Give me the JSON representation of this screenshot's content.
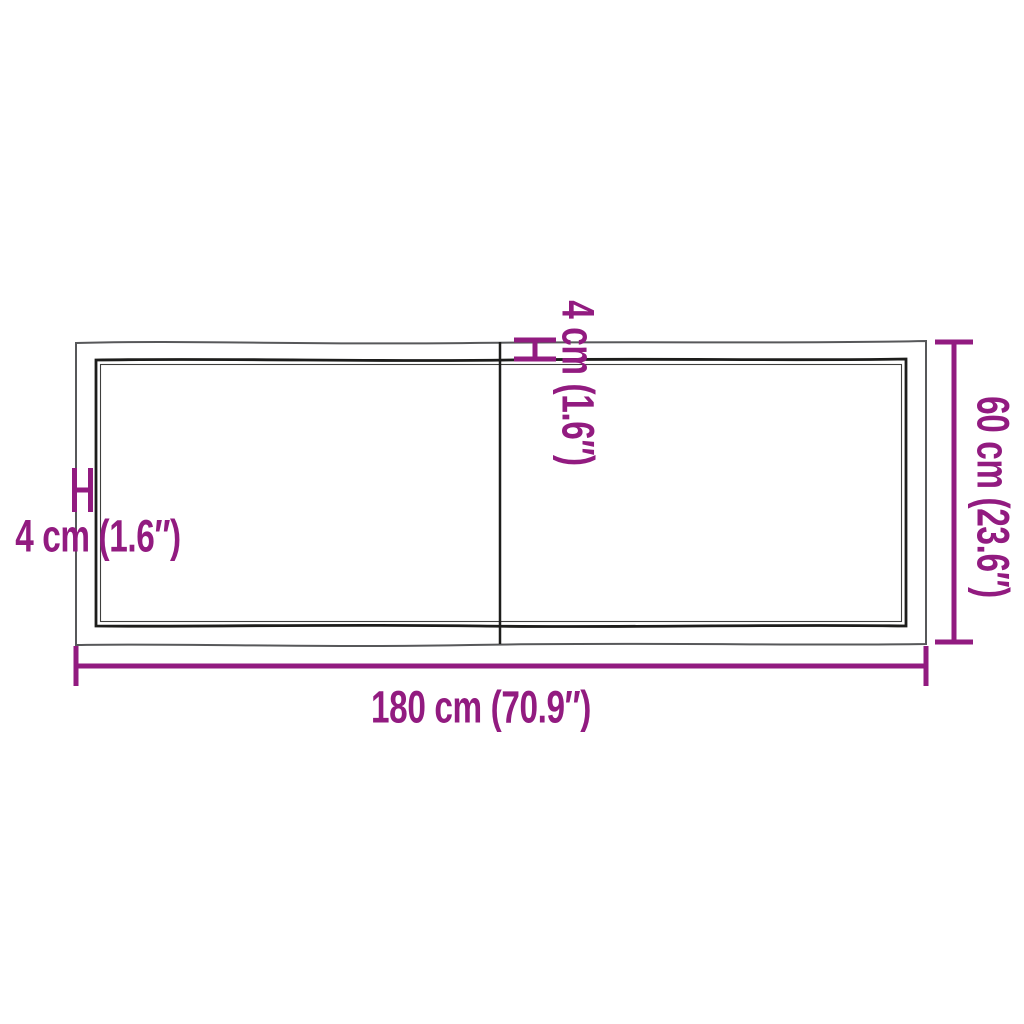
{
  "colors": {
    "background": "#ffffff",
    "accent_magenta": "#921b80",
    "outer_outline_gray": "#57585a",
    "inner_edge_black": "#1d1d1b"
  },
  "labels": {
    "width": "180 cm (70.9″)",
    "depth": "60 cm (23.6″)",
    "thickness_left": "4 cm (1.6″)",
    "thickness_top": "4 cm (1.6″)"
  }
}
